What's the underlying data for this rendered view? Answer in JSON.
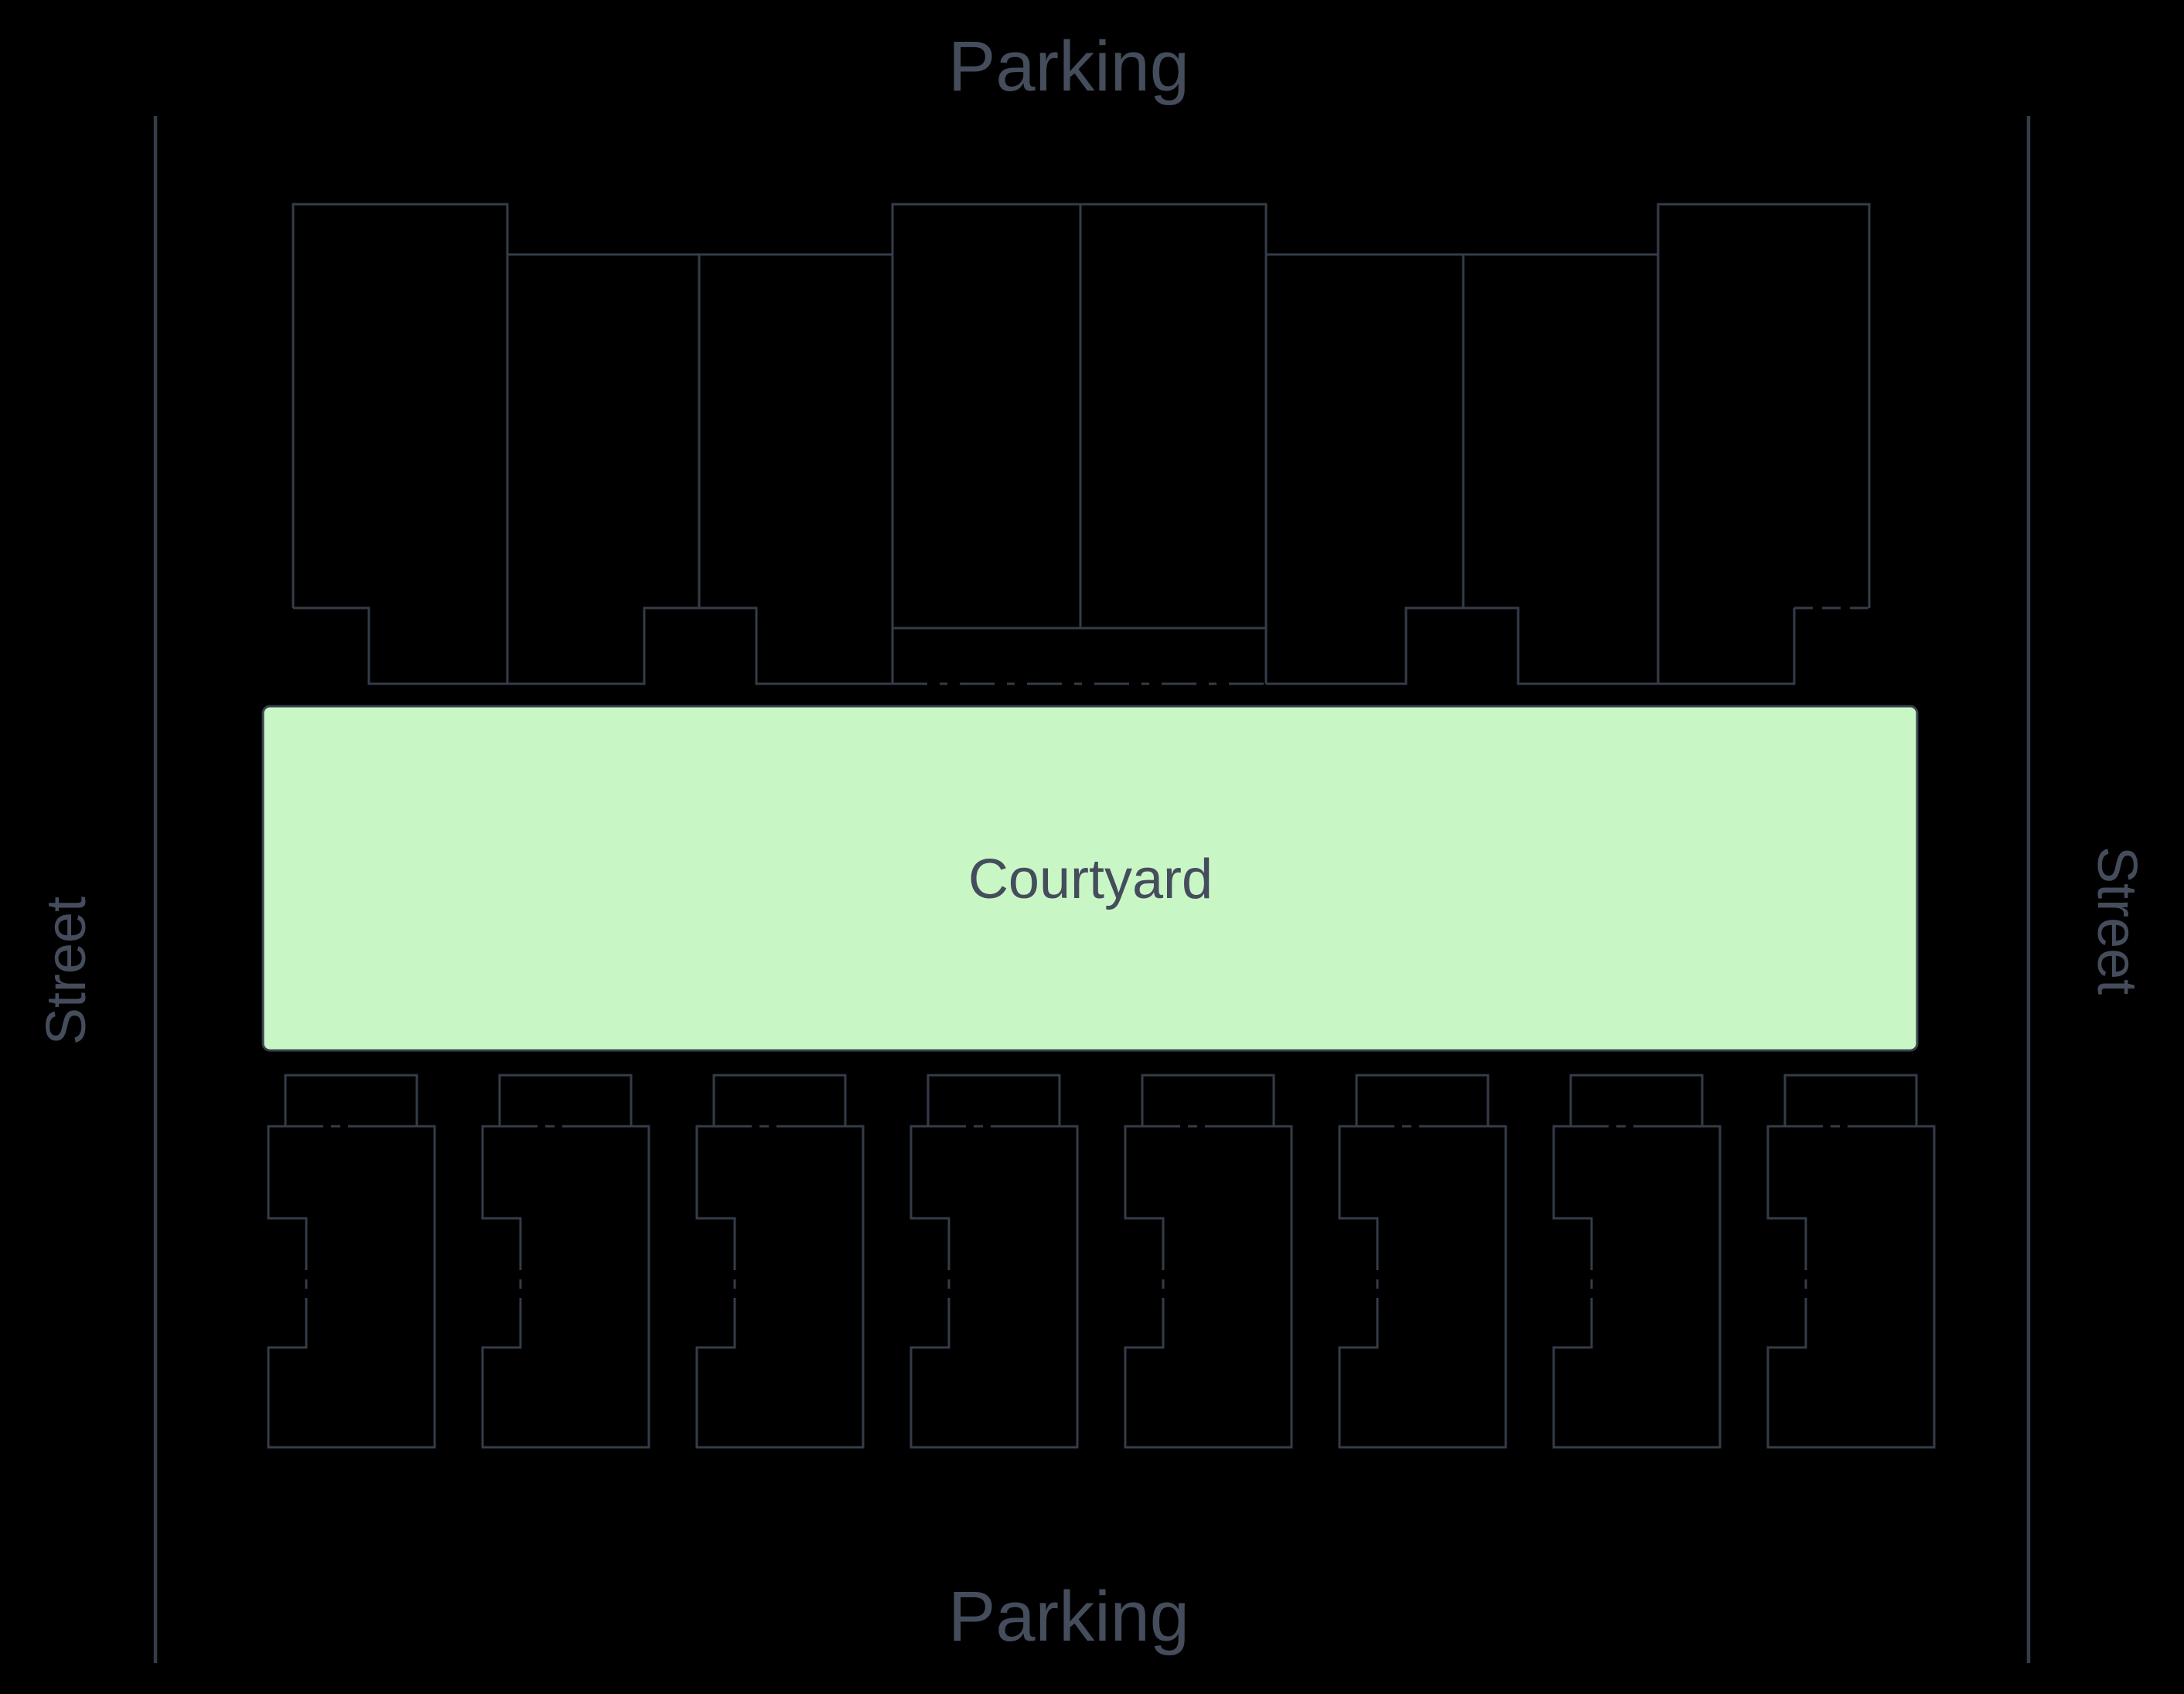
{
  "diagram": {
    "labels": {
      "parking_top": "Parking",
      "parking_bottom": "Parking",
      "street_left": "Street",
      "street_right": "Street",
      "courtyard": "Courtyard"
    },
    "colors": {
      "background": "#000000",
      "outline": "#353c49",
      "label_text": "#454d5c",
      "courtyard_fill": "#c8f7c5",
      "courtyard_border": "#39414f"
    }
  }
}
